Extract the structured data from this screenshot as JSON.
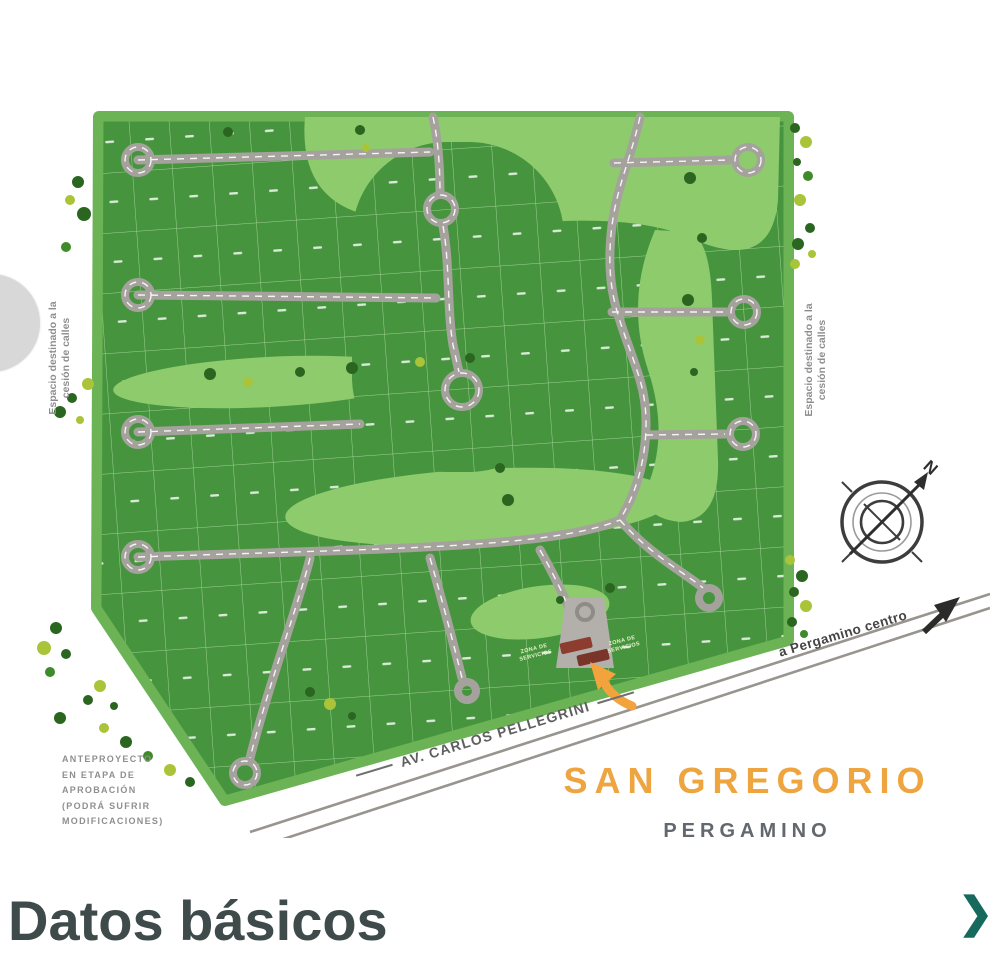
{
  "colors": {
    "accent_teal": "#17695e",
    "heading_dark": "#3f4b4b",
    "map_title_orange": "#eea43f",
    "lot_green": "#46953e",
    "field_green": "#6cb356",
    "open_space_green": "#8ecb6d",
    "road_gray": "#a5a29d",
    "gatehouse_red": "#8d3c30",
    "entrance_arrow_orange": "#f2a33c"
  },
  "header": {
    "read_more_label": "Leer más"
  },
  "map": {
    "project_title": "SAN GREGORIO",
    "project_subtitle": "PERGAMINO",
    "easement_note": "Espacio destinado a la\ncesión de calles",
    "disclaimer": "ANTEPROYECTO\nEN ETAPA DE\nAPROBACIÓN\n(PODRÁ SUFRIR\nMODIFICACIONES)",
    "avenue_label": "AV. CARLOS PELLEGRINI",
    "direction_label": "a Pergamino centro",
    "service_zone_label": "ZONA DE\nSERVICIOS",
    "compass_north_label": "N"
  },
  "footer": {
    "section_title": "Datos básicos",
    "chevron_icon": "❯"
  }
}
